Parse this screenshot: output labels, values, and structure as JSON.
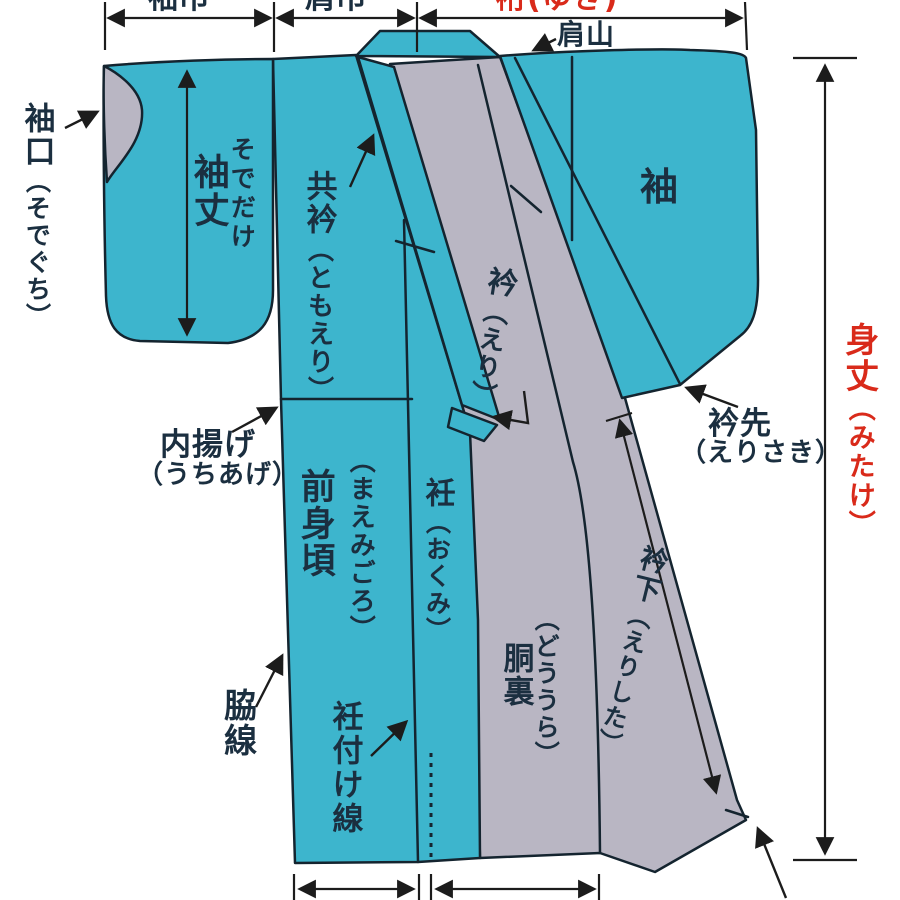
{
  "diagram_title": "kimono-parts-diagram",
  "colors": {
    "fabric_teal": "#3db5cd",
    "lining_gray": "#b9b6c3",
    "outline_navy": "#14242f",
    "dimension_black": "#1c1c1c",
    "accent_red": "#d92a1a",
    "label_navy": "#1b2f40",
    "background": "#ffffff"
  },
  "dimensions": {
    "sode_haba": "袖巾",
    "kata_haba": "肩巾",
    "yuki": "裄(ゆき)",
    "mitake_kanji": "身丈",
    "mitake_kana": "（みたけ）",
    "sodetake_kana": "そでだけ",
    "sodetake_kanji": "袖丈",
    "erishita_kanji": "衿下",
    "erishita_kana": "（えりした）"
  },
  "parts": {
    "sodeguchi_kanji": "袖口",
    "sodeguchi_kana": "（そでぐち）",
    "tomoeri_kanji": "共衿",
    "tomoeri_kana": "（ともえり）",
    "katayama": "肩山",
    "sode": "袖",
    "eri_kanji": "衿",
    "eri_kana": "（えり）",
    "erisaki_kanji": "衿先",
    "erisaki_kana": "（えりさき）",
    "uchiage_kanji": "内揚げ",
    "uchiage_kana": "（うちあげ）",
    "maemigoro_kana": "（まえみごろ）",
    "maemigoro_kanji": "前身頃",
    "okumi_kanji": "衽",
    "okumi_kana": "（おくみ）",
    "douura_kana": "（どううら）",
    "douura_kanji": "胴裏",
    "wakisen": "脇線",
    "okumitsuke_sen": "衽付け線"
  }
}
